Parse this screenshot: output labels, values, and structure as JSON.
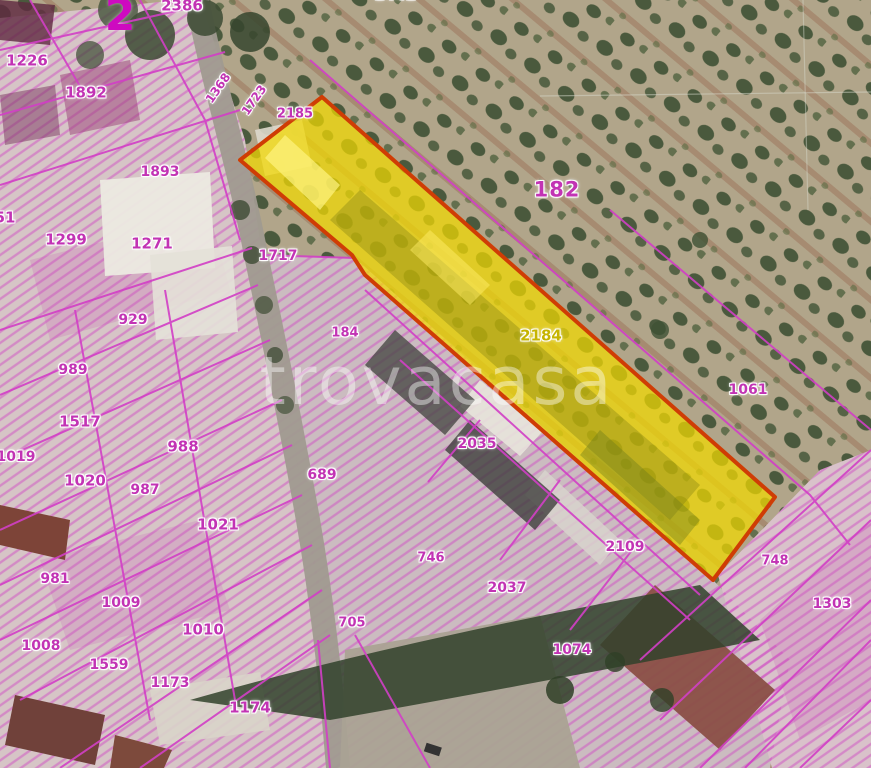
{
  "watermark": {
    "text": "trovacasa"
  },
  "map": {
    "type": "cadastral-satellite-overlay",
    "sheet_number": "2",
    "highlighted_parcel": {
      "label": "2184",
      "fill_color": "#f2d900",
      "outline_color": "#cf3d05"
    },
    "cadastral_line_color": "#d23fc6",
    "label_color": "#c233b4",
    "labels": [
      {
        "text": "2386",
        "x": 182,
        "y": 6,
        "size": 15
      },
      {
        "text": "2",
        "x": 120,
        "y": 16,
        "size": 44,
        "variant": "big"
      },
      {
        "text": "1441",
        "x": 395,
        "y": -5,
        "size": 15
      },
      {
        "text": "1226",
        "x": 27,
        "y": 61,
        "size": 15
      },
      {
        "text": "1892",
        "x": 86,
        "y": 93,
        "size": 15
      },
      {
        "text": "1368",
        "x": 218,
        "y": 88,
        "size": 12,
        "rot": -55
      },
      {
        "text": "1723",
        "x": 254,
        "y": 100,
        "size": 12,
        "rot": -55
      },
      {
        "text": "2185",
        "x": 295,
        "y": 114,
        "size": 13
      },
      {
        "text": "1893",
        "x": 160,
        "y": 172,
        "size": 14
      },
      {
        "text": "51",
        "x": 5,
        "y": 218,
        "size": 15
      },
      {
        "text": "1299",
        "x": 66,
        "y": 240,
        "size": 15
      },
      {
        "text": "1271",
        "x": 152,
        "y": 244,
        "size": 15
      },
      {
        "text": "1717",
        "x": 278,
        "y": 256,
        "size": 14
      },
      {
        "text": "182",
        "x": 557,
        "y": 190,
        "size": 21,
        "variant": "large"
      },
      {
        "text": "929",
        "x": 133,
        "y": 320,
        "size": 14
      },
      {
        "text": "184",
        "x": 345,
        "y": 333,
        "size": 13
      },
      {
        "text": "2184",
        "x": 541,
        "y": 336,
        "size": 15,
        "variant": "yellow"
      },
      {
        "text": "989",
        "x": 73,
        "y": 370,
        "size": 14
      },
      {
        "text": "1061",
        "x": 748,
        "y": 390,
        "size": 14
      },
      {
        "text": "1517",
        "x": 80,
        "y": 422,
        "size": 15
      },
      {
        "text": "2035",
        "x": 477,
        "y": 444,
        "size": 14
      },
      {
        "text": "988",
        "x": 183,
        "y": 447,
        "size": 15
      },
      {
        "text": "1019",
        "x": 16,
        "y": 457,
        "size": 14
      },
      {
        "text": "689",
        "x": 322,
        "y": 475,
        "size": 14
      },
      {
        "text": "1020",
        "x": 85,
        "y": 481,
        "size": 15
      },
      {
        "text": "987",
        "x": 145,
        "y": 490,
        "size": 14
      },
      {
        "text": "1021",
        "x": 218,
        "y": 525,
        "size": 15
      },
      {
        "text": "2109",
        "x": 625,
        "y": 547,
        "size": 14
      },
      {
        "text": "746",
        "x": 431,
        "y": 558,
        "size": 13
      },
      {
        "text": "748",
        "x": 775,
        "y": 561,
        "size": 13
      },
      {
        "text": "981",
        "x": 55,
        "y": 579,
        "size": 14
      },
      {
        "text": "2037",
        "x": 507,
        "y": 588,
        "size": 14
      },
      {
        "text": "1009",
        "x": 121,
        "y": 603,
        "size": 14
      },
      {
        "text": "1303",
        "x": 832,
        "y": 604,
        "size": 14
      },
      {
        "text": "705",
        "x": 352,
        "y": 623,
        "size": 13
      },
      {
        "text": "1010",
        "x": 203,
        "y": 630,
        "size": 15
      },
      {
        "text": "1008",
        "x": 41,
        "y": 646,
        "size": 14
      },
      {
        "text": "1074",
        "x": 572,
        "y": 650,
        "size": 14
      },
      {
        "text": "1559",
        "x": 109,
        "y": 665,
        "size": 14
      },
      {
        "text": "1173",
        "x": 170,
        "y": 683,
        "size": 14
      },
      {
        "text": "1174",
        "x": 250,
        "y": 708,
        "size": 15
      }
    ]
  }
}
